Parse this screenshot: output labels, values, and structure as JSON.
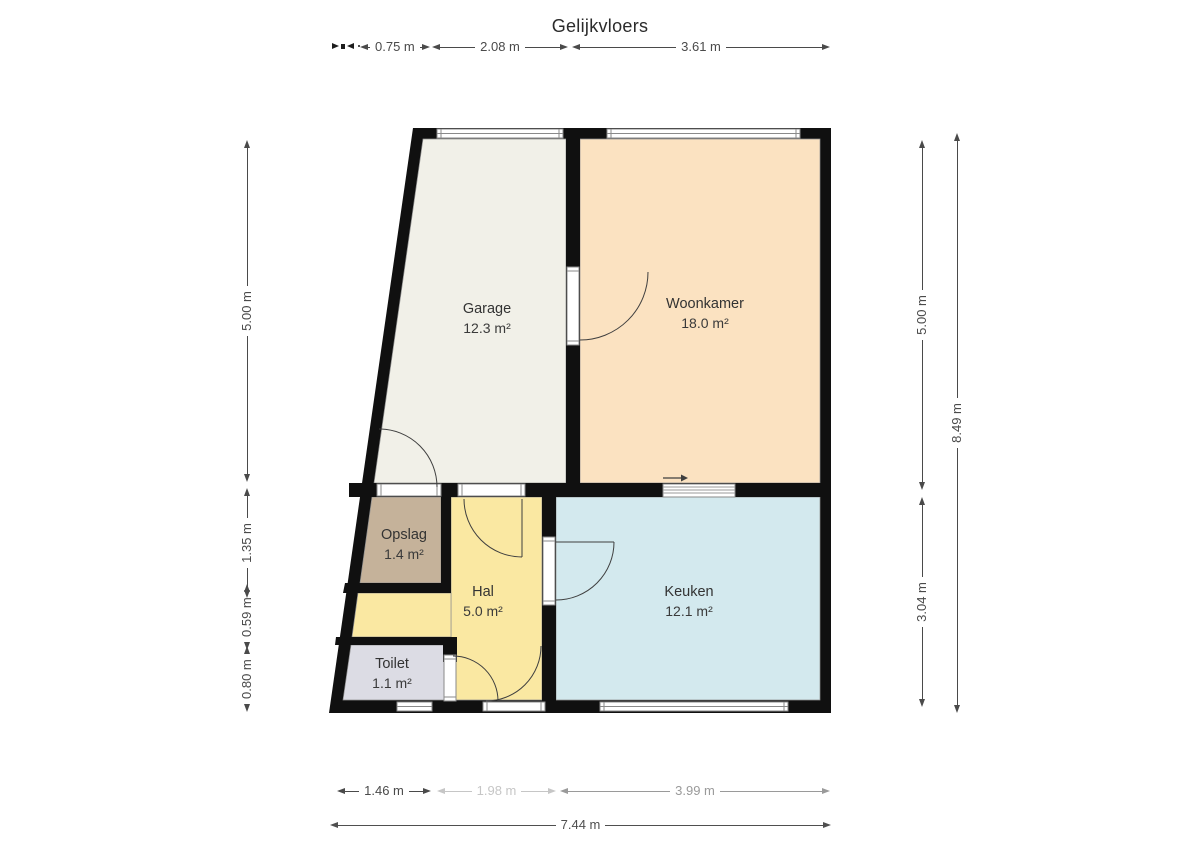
{
  "title": "Gelijkvloers",
  "rooms": [
    {
      "name": "Garage",
      "area": "12.3 m²",
      "color": "#f1f0e8"
    },
    {
      "name": "Woonkamer",
      "area": "18.0 m²",
      "color": "#fbe2c1"
    },
    {
      "name": "Opslag",
      "area": "1.4 m²",
      "color": "#c5b29a"
    },
    {
      "name": "Hal",
      "area": "5.0 m²",
      "color": "#fae8a2"
    },
    {
      "name": "Toilet",
      "area": "1.1 m²",
      "color": "#dcdce4"
    },
    {
      "name": "Keuken",
      "area": "12.1 m²",
      "color": "#d3e9ee"
    }
  ],
  "dimensions": {
    "top": [
      "0.75 m",
      "2.08 m",
      "3.61 m"
    ],
    "bottom_segments": [
      "1.46 m",
      "1.98 m",
      "3.99 m"
    ],
    "bottom_total": "7.44 m",
    "left": [
      "5.00 m",
      "1.35 m",
      "0.59 m",
      "0.80 m"
    ],
    "right_inner": [
      "5.00 m",
      "3.04 m"
    ],
    "right_total": "8.49 m"
  },
  "colors": {
    "wall": "#101010",
    "window_frame": "#8a8a8a",
    "door_arc": "#3f3f3f",
    "dimension_text": "#4a4a4a",
    "faded_dimension_text": "#c6c6c6"
  }
}
